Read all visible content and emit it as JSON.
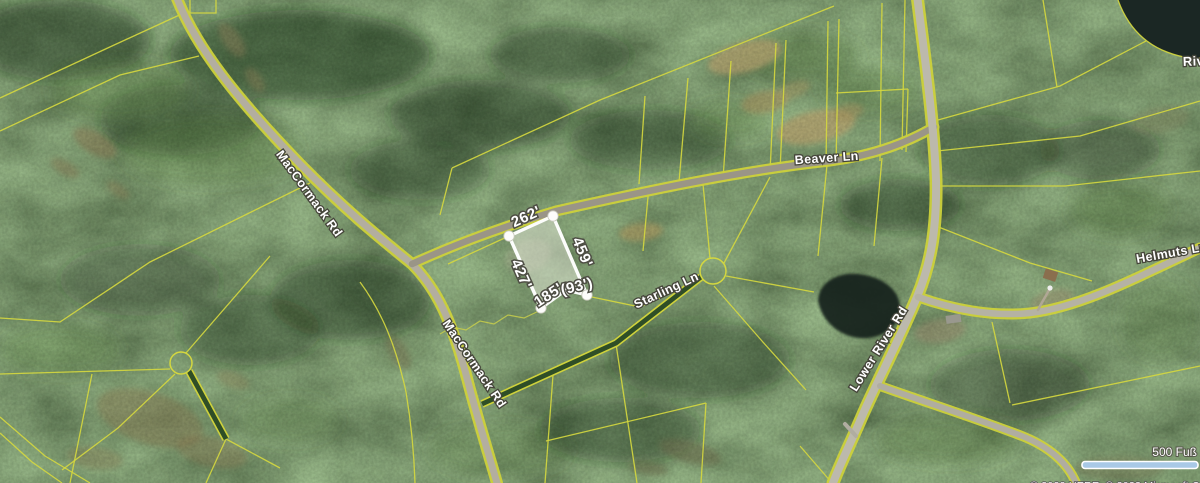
{
  "roads": [
    {
      "name": "maccormack-rd-upper",
      "label": "MacCormack Rd"
    },
    {
      "name": "beaver-ln",
      "label": "Beaver Ln"
    },
    {
      "name": "starling-ln",
      "label": "Starling Ln"
    },
    {
      "name": "maccormack-rd-lower",
      "label": "MacCormack Rd"
    },
    {
      "name": "lower-river-rd",
      "label": "Lower River Rd"
    },
    {
      "name": "helmuts-ln",
      "label": "Helmuts Ln"
    },
    {
      "name": "river",
      "label": "Riv"
    }
  ],
  "parcel": {
    "dimension_labels": {
      "top": "262'",
      "right": "459'",
      "left": "427'",
      "bottom_left": "185'",
      "bottom_right": "(93')"
    }
  },
  "scale": {
    "distance_label": "500 Fuß"
  },
  "attribution": {
    "text": "© 2023 HERE, © 2023 Microsoft Corporation"
  },
  "colors": {
    "parcel_line": "#d4d73f",
    "highlight": "#ffffff",
    "water": "#1b2724",
    "scale_bar": "#a9c9e6",
    "forest_base": "#2f4f27"
  }
}
